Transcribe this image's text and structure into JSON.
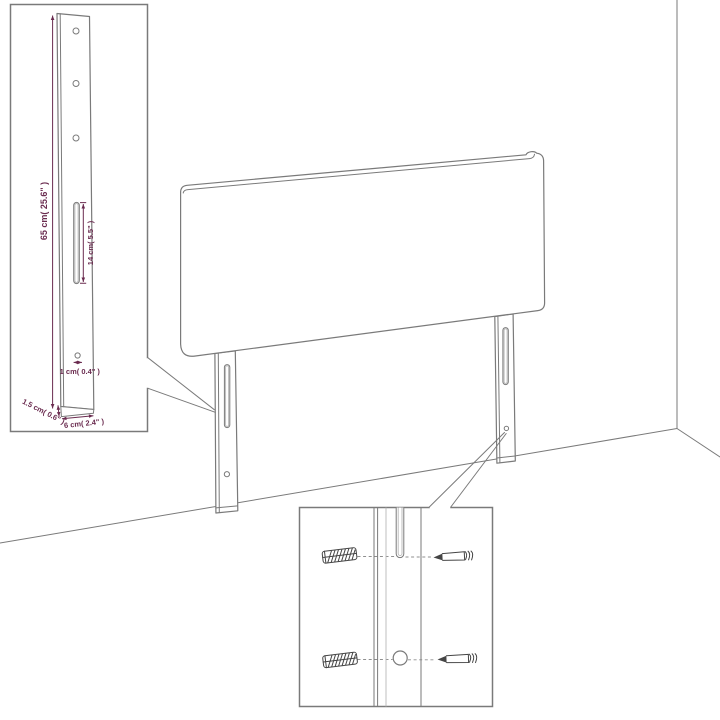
{
  "colors": {
    "background": "#ffffff",
    "outline": "#7a7a7a",
    "outline_dark": "#454545",
    "light_line": "#b8b8b8",
    "dimension": "#6a2b4f"
  },
  "main_view": {
    "subject": "headboard with two mounting legs shown against a wall corner and floor"
  },
  "leg_detail_inset": {
    "height_label": "65 cm( 25.6\" )",
    "slot_height_label": "14 cm( 5.5\" )",
    "hole_diameter_label": "1 cm( 0.4\" )",
    "side_thickness_label": "1.5 cm( 0.6\" )",
    "width_label": "6 cm( 2.4\" )"
  },
  "hardware_detail_inset": {
    "left_parts": [
      "wall-plug-icon",
      "wall-plug-icon"
    ],
    "right_parts": [
      "screw-icon",
      "screw-icon"
    ]
  }
}
